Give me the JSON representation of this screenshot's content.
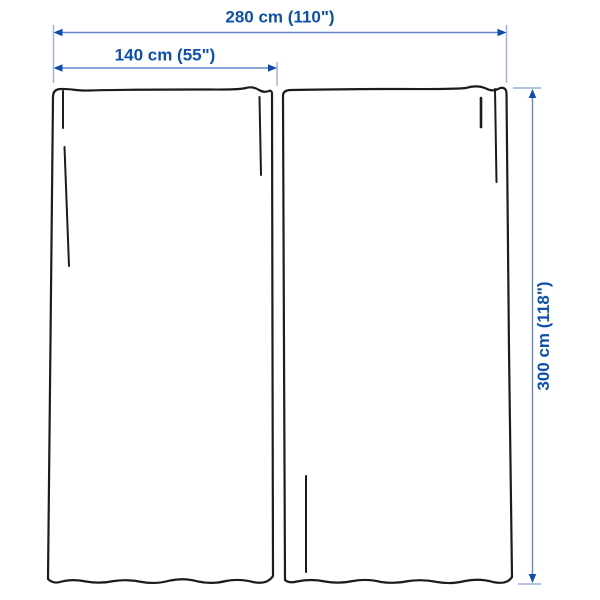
{
  "diagram": {
    "kind": "product-dimension-diagram",
    "panels_shown": 2
  },
  "dimensions": {
    "total_width": "280 cm (110\")",
    "panel_width": "140 cm (55\")",
    "height": "300 cm (118\")"
  },
  "colors": {
    "background": "#ffffff",
    "curtain_outline": "#1c1c1c",
    "dimension_line": "#6286c8",
    "dimension_tick": "#9ab0d9",
    "label_text": "#0d4fae",
    "arrow": "#0d4bad"
  }
}
